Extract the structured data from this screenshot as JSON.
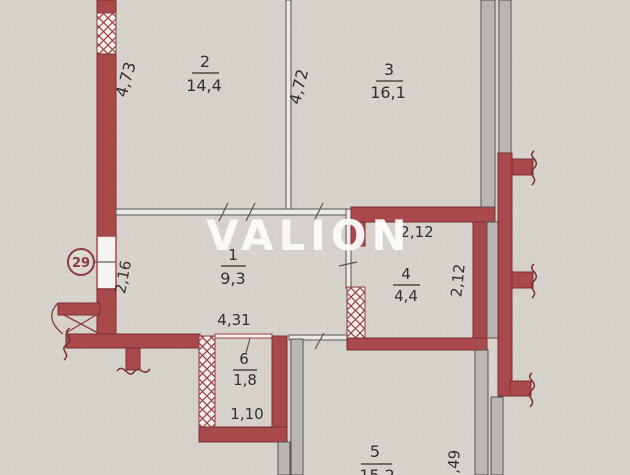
{
  "watermark": {
    "text": "VALION"
  },
  "marker": {
    "label": "29"
  },
  "rooms": {
    "r1": {
      "number": "1",
      "area": "9,3"
    },
    "r2": {
      "number": "2",
      "area": "14,4"
    },
    "r3": {
      "number": "3",
      "area": "16,1"
    },
    "r4": {
      "number": "4",
      "area": "4,4"
    },
    "r5": {
      "number": "5",
      "area": "15,2"
    },
    "r6": {
      "number": "6",
      "area": "1,8"
    }
  },
  "dimensions": {
    "left_wall_length": "4,73",
    "middle_wall_length": "4,72",
    "hall_depth": "2,16",
    "hall_width": "4,31",
    "room4_width": "2,12",
    "room4_depth": "2,12",
    "room6_width": "1,10",
    "room5_edge": ",49"
  },
  "colors": {
    "wall_red": "#a9494b",
    "wall_gray": "#bab7b2",
    "background": "#d6d2cb",
    "text": "#332f2b",
    "marker_red": "#8e3a3c",
    "watermark_white": "#fcfcfa"
  }
}
